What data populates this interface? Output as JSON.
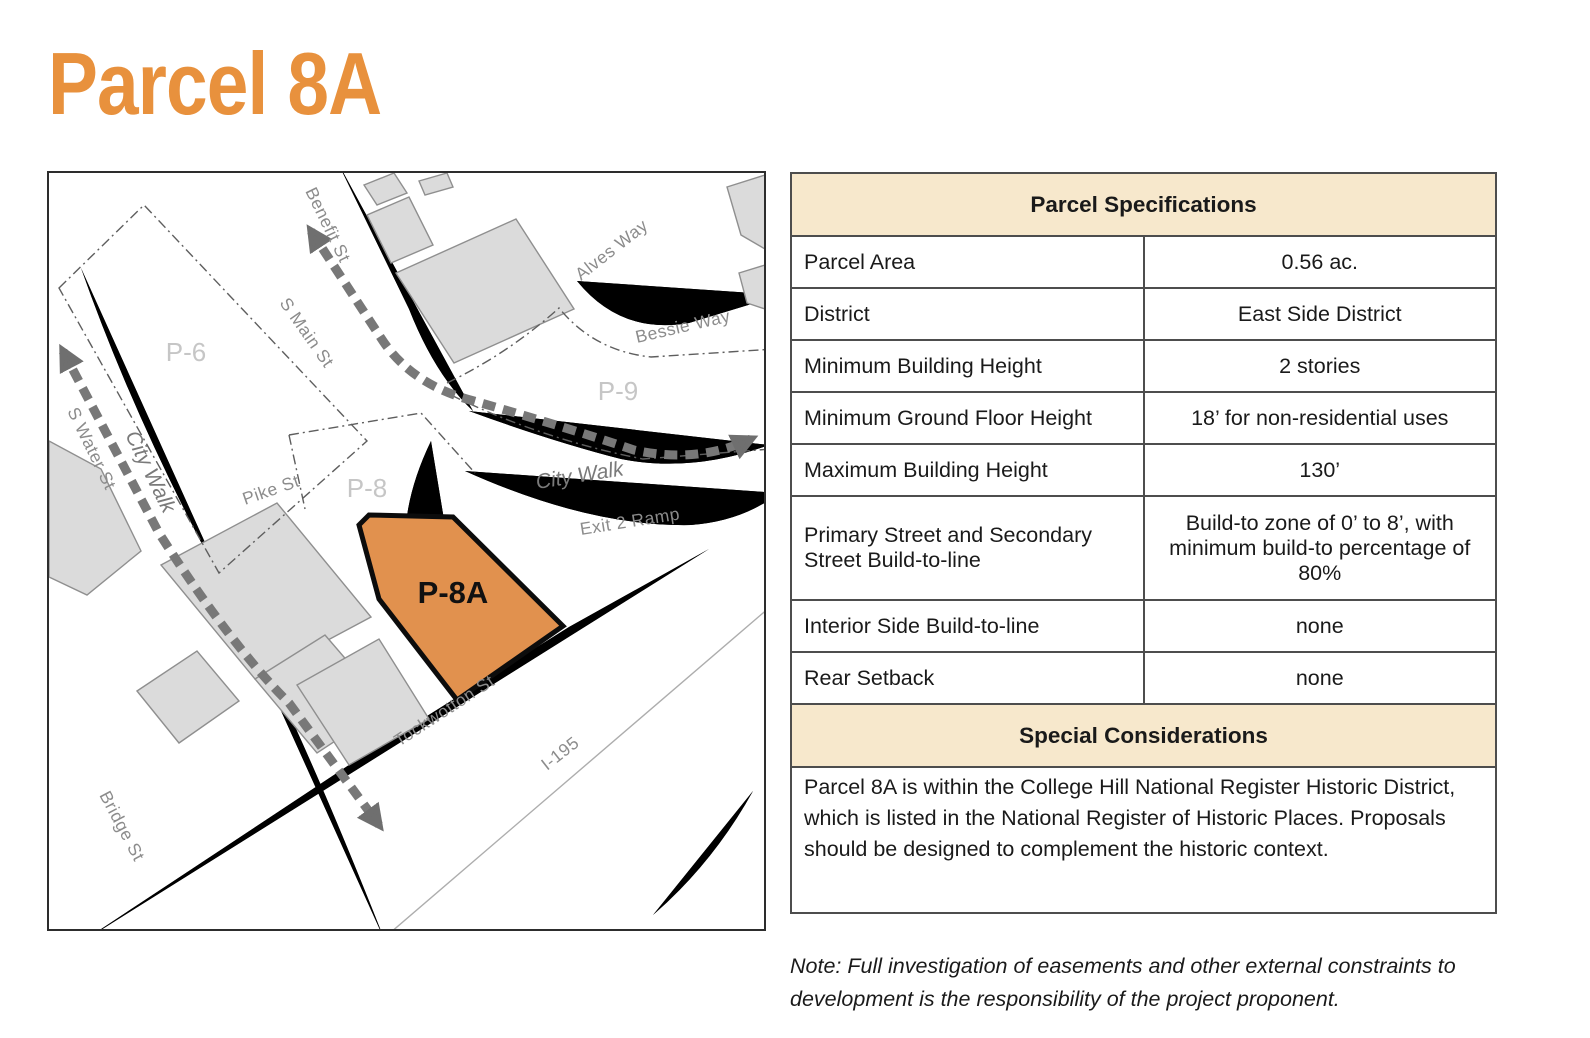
{
  "page": {
    "title": "Parcel 8A"
  },
  "map": {
    "labels": {
      "benefit": "Benefit St",
      "s_main": "S Main St",
      "s_water": "S Water St",
      "city_walk_left": "City Walk",
      "pike": "Pike St",
      "alves": "Alves Way",
      "bessie": "Bessie Way",
      "city_walk_right": "City Walk",
      "exit_ramp": "Exit 2 Ramp",
      "tockwotton": "Tockwotton St",
      "i195": "I-195",
      "bridge": "Bridge St"
    },
    "parcels": {
      "p6": "P-6",
      "p8": "P-8",
      "p9": "P-9",
      "p8a": "P-8A"
    },
    "colors": {
      "highlight_parcel_fill": "#E1914E",
      "highlight_parcel_outline": "#0C0C0C"
    }
  },
  "table": {
    "title": "Parcel Specifications",
    "rows": [
      {
        "label": "Parcel Area",
        "value": "0.56 ac."
      },
      {
        "label": "District",
        "value": "East Side District"
      },
      {
        "label": "Minimum Building Height",
        "value": "2 stories"
      },
      {
        "label": "Minimum Ground Floor Height",
        "value": "18’ for non-residential uses"
      },
      {
        "label": "Maximum Building Height",
        "value": "130’"
      },
      {
        "label": "Primary Street and Secondary Street Build-to-line",
        "value": "Build-to zone of 0’ to 8’, with minimum build-to percentage of 80%"
      },
      {
        "label": "Interior Side Build-to-line",
        "value": "none"
      },
      {
        "label": "Rear Setback",
        "value": "none"
      }
    ],
    "special": {
      "title": "Special Considerations",
      "text": "Parcel 8A is within the College Hill National Register Historic District, which is listed in the National Register of Historic Places. Proposals should be designed to complement the historic context."
    }
  },
  "note": "Note: Full investigation of easements and other external constraints to development is the responsibility of the project proponent."
}
